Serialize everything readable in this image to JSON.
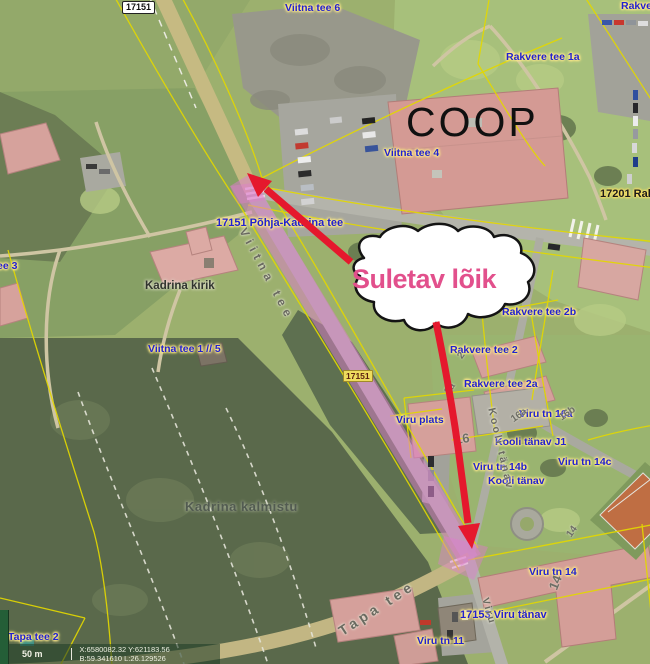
{
  "map_overlay": {
    "closure_text": "Suletav lõik"
  },
  "poi": {
    "store": "COOP"
  },
  "road_labels": {
    "shield_top": "17151",
    "shield_mid": "17151",
    "pohja_kadrina_tee": "17151 Põhja-Kadrina tee",
    "rakvere_tee_17201": "17201 Rakv",
    "viru_tanav_17153": "17153 Viru tänav"
  },
  "address_labels": {
    "viitna_tee_6": "Viitna tee 6",
    "rakvere_partial": "Rakve",
    "rakvere_tee_1a": "Rakvere tee 1a",
    "viitna_tee_4": "Viitna tee 4",
    "viitna_tee_3_partial": "ee 3",
    "viitna_tee_1_5": "Viitna tee 1 // 5",
    "rakvere_tee_2b": "Rakvere tee 2b",
    "rakvere_tee_2": "Rakvere tee 2",
    "rakvere_tee_2a": "Rakvere tee 2a",
    "viru_tn_16a": "Viru tn 16a",
    "viru_plats": "Viru plats",
    "kooli_tanav_j1": "Kooli tänav J1",
    "viru_tn_14b": "Viru tn 14b",
    "kooli_tanav": "Kooli tänav",
    "viru_tn_14c": "Viru tn 14c",
    "viru_tn_14": "Viru tn 14",
    "viru_tn_11": "Viru tn 11",
    "tapa_tee_2": "Tapa tee 2"
  },
  "place_labels": {
    "church": "Kadrina kirik",
    "cemetery": "Kadrina kalmistu"
  },
  "street_names": {
    "viitna_tee": "Viitna tee",
    "tapa_tee": "Tapa tee",
    "kooli_tanav": "Kooli tänav",
    "viru": "Viru"
  },
  "parcel_numbers": {
    "n2": "2",
    "n2a": "2a",
    "n16": "16",
    "n16a": "16a",
    "n16b": "16b",
    "n14": "14",
    "n14_top": "14"
  },
  "statusbar": {
    "scale": "50 m",
    "coord_xy": "X:6580082.32 Y:621183.56",
    "coord_bl": "B:59.341610 L:26.129526"
  },
  "colors": {
    "closure_highlight": "#dd7ecc",
    "closure_text": "#e2508c",
    "arrow_red": "#e6192e",
    "cadastral_yellow": "#e4d800",
    "address_blue": "#2121d0"
  }
}
